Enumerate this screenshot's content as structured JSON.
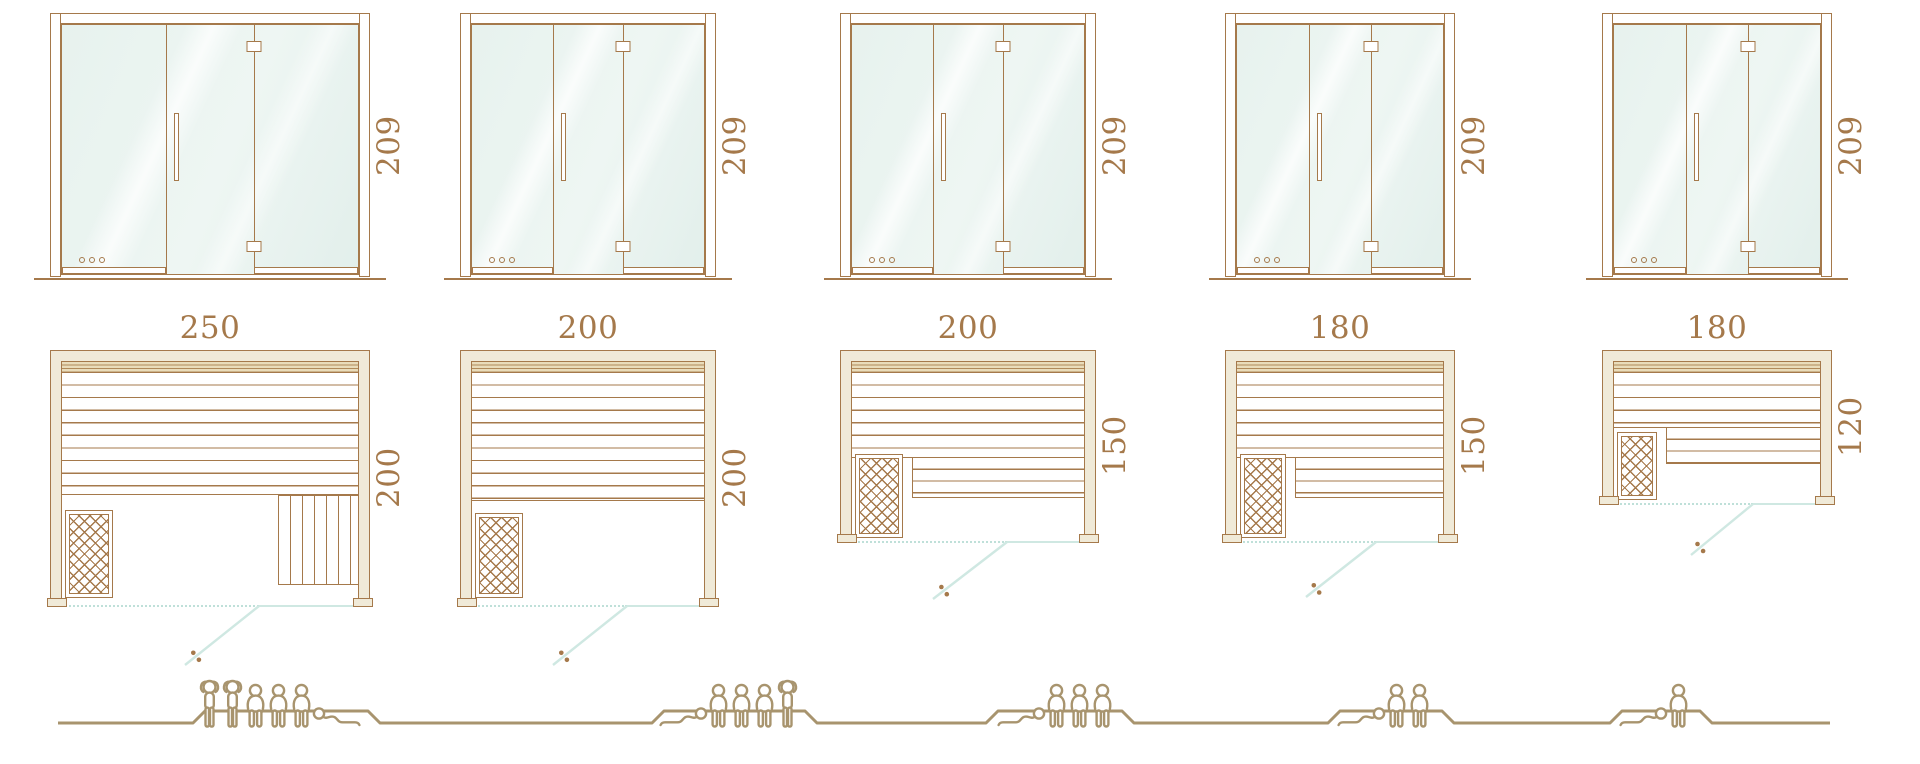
{
  "diagram": {
    "type": "sauna-size-comparison",
    "rows": [
      "front-elevations",
      "floor-plans",
      "capacity-figures"
    ]
  },
  "colors": {
    "line": "#a5794b",
    "dim_text": "#a5794b",
    "glass": "#e7f2ee",
    "wall": "#f0ead8",
    "backband_bg": "#e9dcba",
    "backband_line": "#b08a5a",
    "teal": "#cfe8e2",
    "teal_dotted": "#bfe0d9",
    "people": "#a8946e",
    "white": "#ffffff"
  },
  "scale_px_per_cm": 1.28,
  "icons": {
    "person_standing": "person-standing-icon",
    "person_sitting": "person-sitting-icon",
    "person_lying": "person-lying-icon",
    "heater": "sauna-heater-icon",
    "vents": "vent-holes-icon"
  },
  "models": [
    {
      "id": "250x200",
      "labels": {
        "height": "209",
        "width": "250",
        "depth": "200"
      },
      "dimensions_cm": {
        "width": 250,
        "depth": 200,
        "height": 209
      },
      "capacity": {
        "total": 6,
        "figures": [
          "standing",
          "standing",
          "sitting",
          "sitting",
          "sitting",
          "lying"
        ],
        "lying_mirrored": true
      },
      "geometry": {
        "x": 50,
        "bench_px": 122,
        "heater": {
          "w": 48,
          "h": 88,
          "gap": 8
        },
        "side_bench": {
          "w": 80,
          "h": 90
        },
        "l_bench_extra": 0,
        "door_frac": 0.65,
        "swing": {
          "dx": -74,
          "dy": 58
        },
        "people_x": 197,
        "plateau": [
          193,
          368
        ]
      }
    },
    {
      "id": "200x200",
      "labels": {
        "height": "209",
        "width": "200",
        "depth": "200"
      },
      "dimensions_cm": {
        "width": 200,
        "depth": 200,
        "height": 209
      },
      "capacity": {
        "total": 5,
        "figures": [
          "lying",
          "sitting",
          "sitting",
          "sitting",
          "standing"
        ],
        "lying_mirrored": false
      },
      "geometry": {
        "x": 460,
        "bench_px": 128,
        "heater": {
          "w": 48,
          "h": 85,
          "gap": 8
        },
        "side_bench": null,
        "l_bench_extra": 0,
        "door_frac": 0.65,
        "swing": {
          "dx": -74,
          "dy": 58
        },
        "people_x": 658,
        "plateau": [
          652,
          805
        ]
      }
    },
    {
      "id": "200x150",
      "labels": {
        "height": "209",
        "width": "200",
        "depth": "150"
      },
      "dimensions_cm": {
        "width": 200,
        "depth": 150,
        "height": 209
      },
      "capacity": {
        "total": 4,
        "figures": [
          "lying",
          "sitting",
          "sitting",
          "sitting"
        ],
        "lying_mirrored": false
      },
      "geometry": {
        "x": 840,
        "bench_px": 85,
        "heater": {
          "w": 48,
          "h": 84,
          "gap": 4
        },
        "side_bench": null,
        "l_bench_extra": 40,
        "door_frac": 0.65,
        "swing": {
          "dx": -74,
          "dy": 56
        },
        "people_x": 996,
        "plateau": [
          986,
          1122
        ]
      }
    },
    {
      "id": "180x150",
      "labels": {
        "height": "209",
        "width": "180",
        "depth": "150"
      },
      "dimensions_cm": {
        "width": 180,
        "depth": 150,
        "height": 209
      },
      "capacity": {
        "total": 3,
        "figures": [
          "lying",
          "sitting",
          "sitting"
        ],
        "lying_mirrored": false
      },
      "geometry": {
        "x": 1225,
        "bench_px": 85,
        "heater": {
          "w": 46,
          "h": 84,
          "gap": 4
        },
        "side_bench": null,
        "l_bench_extra": 40,
        "door_frac": 0.65,
        "swing": {
          "dx": -70,
          "dy": 54
        },
        "people_x": 1336,
        "plateau": [
          1328,
          1442
        ]
      }
    },
    {
      "id": "180x120",
      "labels": {
        "height": "209",
        "width": "180",
        "depth": "120"
      },
      "dimensions_cm": {
        "width": 180,
        "depth": 120,
        "height": 209
      },
      "capacity": {
        "total": 2,
        "figures": [
          "lying",
          "sitting"
        ],
        "lying_mirrored": false
      },
      "geometry": {
        "x": 1602,
        "bench_px": 55,
        "heater": {
          "w": 40,
          "h": 68,
          "gap": 4
        },
        "side_bench": null,
        "l_bench_extra": 36,
        "door_frac": 0.65,
        "swing": {
          "dx": -62,
          "dy": 50
        },
        "people_x": 1618,
        "plateau": [
          1610,
          1700
        ]
      }
    }
  ],
  "ground": {
    "x_start": 58,
    "x_end": 1830,
    "y_low": 723,
    "y_high": 711,
    "slant": 12
  }
}
